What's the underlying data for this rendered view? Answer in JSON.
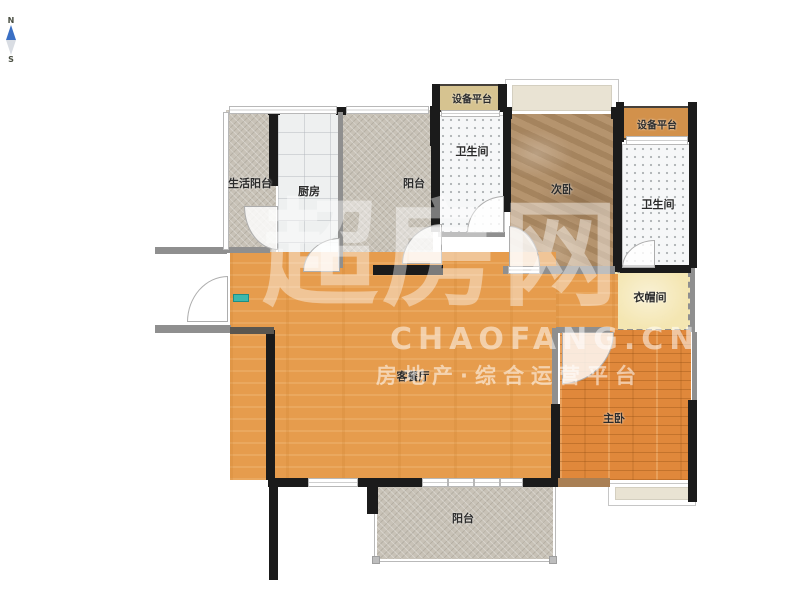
{
  "compass": {
    "north": "N",
    "south": "S"
  },
  "watermark": {
    "logo": "超房网",
    "brand": "CHAOFANG.CN",
    "tagline": "房地产·综合运营平台"
  },
  "rooms": [
    {
      "id": "living-balcony",
      "label": "生活阳台"
    },
    {
      "id": "kitchen",
      "label": "厨房"
    },
    {
      "id": "balcony-top",
      "label": "阳台"
    },
    {
      "id": "equipment-platform-top",
      "label": "设备平台"
    },
    {
      "id": "bathroom-top",
      "label": "卫生间"
    },
    {
      "id": "bedroom-second",
      "label": "次卧"
    },
    {
      "id": "equipment-platform-right",
      "label": "设备平台"
    },
    {
      "id": "bathroom-right",
      "label": "卫生间"
    },
    {
      "id": "cloakroom",
      "label": "衣帽间"
    },
    {
      "id": "living-dining",
      "label": "客餐厅"
    },
    {
      "id": "bedroom-master",
      "label": "主卧"
    },
    {
      "id": "balcony-bottom",
      "label": "阳台"
    }
  ],
  "colors": {
    "wall": "#1b1b1b",
    "wood_living": "#e69c4d",
    "wood_master": "#e0883b",
    "tile_gray": "#c8c2b7",
    "marble_brown": "#b08e68",
    "platform_tan": "#d6c390",
    "platform_orange": "#d2914b",
    "cloakroom_cream": "#f4e6b2",
    "compass_needle": "#3a6fc4",
    "marker_teal": "#3cb8ad"
  }
}
